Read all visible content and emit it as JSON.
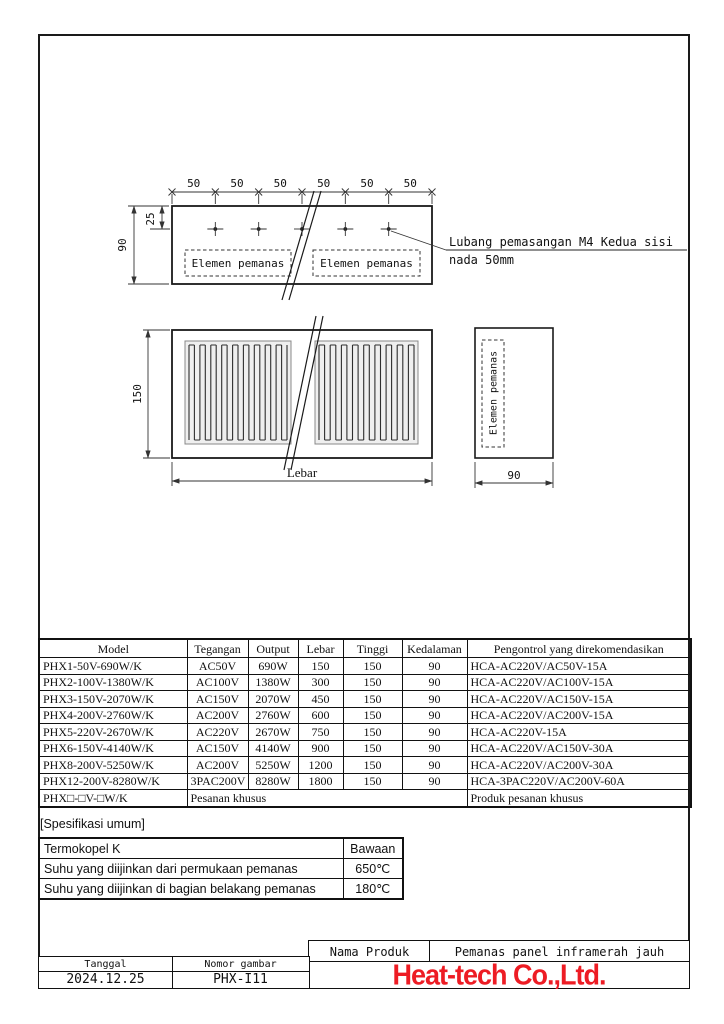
{
  "drawing": {
    "dim50": [
      "50",
      "50",
      "50",
      "50",
      "50",
      "50"
    ],
    "dim25": "25",
    "dim90_top": "90",
    "dim150": "150",
    "dim_lebar": "Lebar",
    "dim90_side": "90",
    "element_label_left": "Elemen pemanas",
    "element_label_right": "Elemen pemanas",
    "element_label_side": "Elemen pemanas",
    "annotation_line1": "Lubang pemasangan M4 Kedua sisi",
    "annotation_line2": "nada 50mm"
  },
  "table": {
    "headers": [
      "Model",
      "Tegangan",
      "Output",
      "Lebar",
      "Tinggi",
      "Kedalaman",
      "Pengontrol yang direkomendasikan"
    ],
    "rows": [
      [
        "PHX1-50V-690W/K",
        "AC50V",
        "690W",
        "150",
        "150",
        "90",
        "HCA-AC220V/AC50V-15A"
      ],
      [
        "PHX2-100V-1380W/K",
        "AC100V",
        "1380W",
        "300",
        "150",
        "90",
        "HCA-AC220V/AC100V-15A"
      ],
      [
        "PHX3-150V-2070W/K",
        "AC150V",
        "2070W",
        "450",
        "150",
        "90",
        "HCA-AC220V/AC150V-15A"
      ],
      [
        "PHX4-200V-2760W/K",
        "AC200V",
        "2760W",
        "600",
        "150",
        "90",
        "HCA-AC220V/AC200V-15A"
      ],
      [
        "PHX5-220V-2670W/K",
        "AC220V",
        "2670W",
        "750",
        "150",
        "90",
        "HCA-AC220V-15A"
      ],
      [
        "PHX6-150V-4140W/K",
        "AC150V",
        "4140W",
        "900",
        "150",
        "90",
        "HCA-AC220V/AC150V-30A"
      ],
      [
        "PHX8-200V-5250W/K",
        "AC200V",
        "5250W",
        "1200",
        "150",
        "90",
        "HCA-AC220V/AC200V-30A"
      ],
      [
        "PHX12-200V-8280W/K",
        "3PAC200V",
        "8280W",
        "1800",
        "150",
        "90",
        "HCA-3PAC220V/AC200V-60A"
      ]
    ],
    "custom_row": {
      "model": "PHX□-□V-□W/K",
      "merged": "Pesanan khusus",
      "controller": "Produk pesanan khusus"
    }
  },
  "specs": {
    "title": "[Spesifikasi umum]",
    "rows": [
      [
        "Termokopel K",
        "Bawaan"
      ],
      [
        "Suhu yang diijinkan dari permukaan pemanas",
        "650℃"
      ],
      [
        "Suhu yang diijinkan di bagian belakang pemanas",
        "180℃"
      ]
    ]
  },
  "footer": {
    "nama_produk_label": "Nama Produk",
    "nama_produk_value": "Pemanas panel inframerah jauh",
    "tanggal_label": "Tanggal",
    "tanggal_value": "2024.12.25",
    "nomor_gambar_label": "Nomor gambar",
    "nomor_gambar_value": "PHX-I11",
    "company": "Heat-tech Co.,Ltd.",
    "company_color": "#ed1c24"
  }
}
